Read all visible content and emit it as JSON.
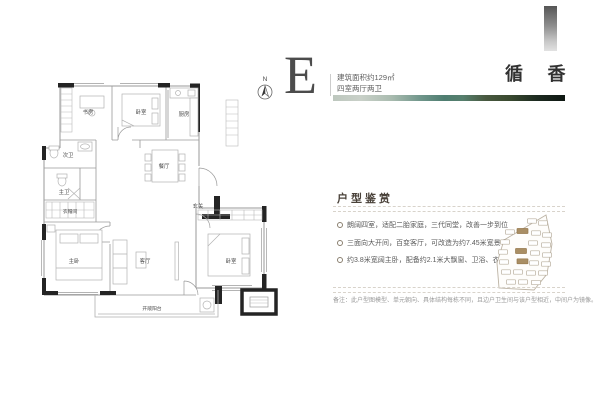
{
  "header": {
    "unit_letter": "E",
    "area_line": "建筑面积约129㎡",
    "layout_line": "四室两厅两卫",
    "brand_title": "循 香"
  },
  "floor_plan": {
    "compass_label": "N",
    "room_labels": {
      "study": "书房",
      "bedroom_top": "卧室",
      "kitchen": "厨房",
      "bath_second": "次卫",
      "bath_master": "主卫",
      "closet": "衣帽间",
      "bedroom_master": "主卧",
      "living": "客厅",
      "dining": "餐厅",
      "foyer": "玄关",
      "bedroom_south": "卧室",
      "balcony": "开敞阳台"
    }
  },
  "appreciation": {
    "title": "户型鉴赏",
    "bullets": [
      "朗阔四室，适配二胎家庭，三代同堂，改善一步到位",
      "三面向大开间，百变客厅，可改造为约7.45米宽景客厅",
      "约3.8米宽阔主卧，配备约2.1米大飘窗、卫浴、衣帽间"
    ],
    "disclaimer": "备注：此户型图模型、单元朝向、具体结构每栋不同，且边户卫生间与该户型相近，中间户为镜像。"
  },
  "colors": {
    "wall_dark": "#242424",
    "line_gray": "#9a9a9a",
    "brand_text": "#313131",
    "strip_green_mid": "#4e7d70",
    "strip_green_dark": "#0f1712",
    "site_highlight": "#a98e64",
    "gray_bar_top": "#565656"
  }
}
